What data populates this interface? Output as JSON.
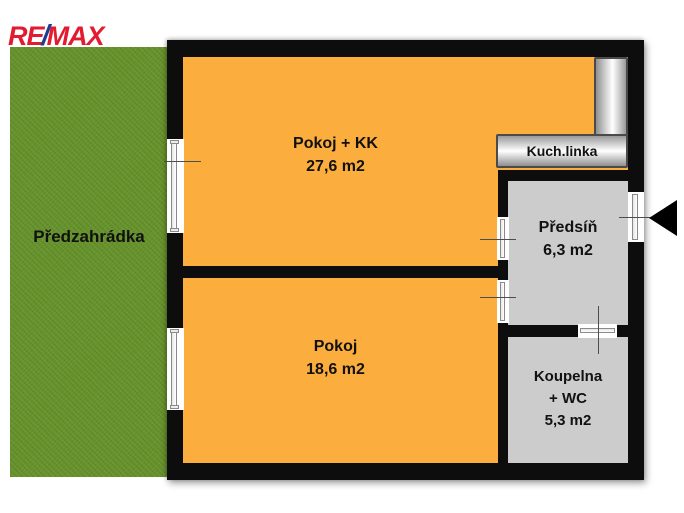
{
  "logo": {
    "re": "RE",
    "slash": "/",
    "max": "MAX"
  },
  "garden": {
    "label": "Předzahrádka"
  },
  "floorplan": {
    "kitchen_unit": {
      "label": "Kuch.linka"
    },
    "rooms": [
      {
        "name": "Pokoj + KK",
        "area": "27,6 m2"
      },
      {
        "name": "Pokoj",
        "area": "18,6 m2"
      },
      {
        "name": "Předsíň",
        "area": "6,3 m2"
      },
      {
        "name": "Koupelna",
        "name2": "+ WC",
        "area": "5,3 m2"
      }
    ]
  },
  "colors": {
    "room_orange": "#fbae3e",
    "room_gray": "#cccccc",
    "garden_green": "#67942c",
    "wall_black": "#0d0d0d",
    "logo_red": "#e21b30",
    "logo_blue": "#1c3e91"
  }
}
